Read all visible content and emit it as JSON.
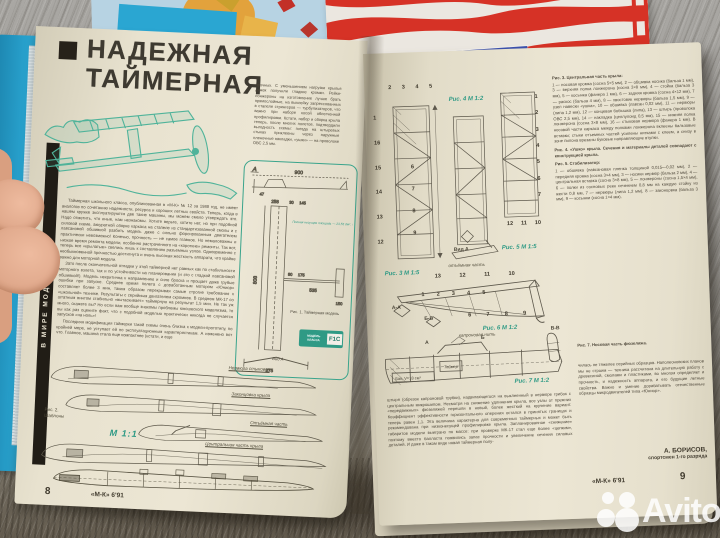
{
  "photo": {
    "watermark_brand": "Avito"
  },
  "colors": {
    "teal_ink": "#2f9a85",
    "paper": "#e8e2cf",
    "banner_blue": "#3d52ae",
    "stripe_red": "#d63226",
    "book_cyan": "#2aa6d2"
  },
  "background_magazines": {
    "banner_title": "ЛИЧНОЕ ОРУЖИЕ"
  },
  "left_page": {
    "rubric_strip": "В МИРЕ МОДЕЛЕЙ",
    "headline": {
      "line1": "НАДЕЖНАЯ",
      "line2": "ТАЙМЕРНАЯ"
    },
    "intro_column": "прочных. С уменьшением нагрузки крылья дужек получили гладкие кромки. Рейки-лонжероны на изготовление лучше брать прямослойные, на выклейку запрессованных в стапеле стрингеров — турбулизаторов, что важно при наборе косой облегченной профилировки. Кстати, набор и сборка крыла теперь, после многих полетов, подтвердили выгодность схемы: гнезда на штыревых стыках приклеены через наружные пленочные накладки, «ушки» — на проволоке ОВС 2,5 мм.",
    "body_p1": "Таймерная школьного класса, опубликованная в «М-К» № 12 за 1988 год, не имеет аналогов по сочетанию надежности, ресурса и хороших летных свойств. Теперь, когда в нашем кружке эксплуатируются две такие машины, мы можем смело утверждать это. Надо отметить, что иные, нам незнакомы. Хотите верьте, хотите нет, но при подобной силовой схеме, аккуратной сборке каркаса на стапеле из стандартизованной смолы и с лавсановой обшивкой разбить модель даже с сильно форсированным двигателем практически невозможно! Конечно, прочность — не самое главное. Но немаловажны и низкое время ремонта модели, особенно растраченного на «короткие» ремонты. Так вот, теперь все «крылатые» свелись лишь к составлению разъемных узлов. Одновременно с необыкновенной прочностью достигнута и очень высокая жесткость аппарата, что крайне важно для моторной модели.",
    "body_p2": "Зато после окончательной отладки у этой таймерной нет равных как по стабильности моторного взлета, так и по устойчивости на планировании (и это с гладкой лавсановой обшивкой!). Модель некритична к направлению и силе броска и прощает даже грубые ошибки при запуске. Среднее время полета с доработанным мотором «Юниор» составляет более 3 мин, таким образом перекрывая самые строгие требования к «школьной» технике. Результаты с серийным двигателем скромнее. В среднем МК-17 со штатным винтом стабильно «вытаскивает» таймерную на результат 1,5 мин. Не так уж много, скажете вы? Но если вам вообще знакомы проблемы юношеского моделизма, то вы как раз оцените факт, что с подобной моделью практически никогда не случается запусков «на ноль»!",
    "body_p3": "Последняя модификация таймерки такой схемы очень близка к модели-прототипу, по крайней мере, не уступает ей по эксплуатационным характеристикам. А изменено вот что. Главное, машина стала еще компактнее (кстати, и еще",
    "fig1": {
      "marker_a": "А",
      "annotation": "Полная несущая площадь — 23,55 дм². Профиль крыла — плосковыпуклый, установочный угол +2°. Нагрузка при полетной массе — 19 г/дм².",
      "caption": "Рис. 1. Таймерная модель",
      "view_label": "Вид А",
      "badge": {
        "line1": "МОДЕЛЬ",
        "line2": "КЛАССА",
        "class_code": "F1C"
      },
      "dims": {
        "d900": "900",
        "d47": "47",
        "d808": "808",
        "d258": "258",
        "d30": "30",
        "d145": "145",
        "d80": "80",
        "d175": "175",
        "d535": "535",
        "d150": "150",
        "d275": "275"
      }
    },
    "fig2": {
      "label_line1": "Рис. 2.",
      "label_line2": "Шаблоны",
      "scale": "М 1:1",
      "labels": [
        "Нервюра стыковая",
        "Законцовка крыла",
        "Отъёмная часть",
        "Центральная часть крыла"
      ]
    },
    "footer": {
      "page": "8",
      "issue": "«М-К» 6'91"
    }
  },
  "right_page": {
    "fig3": {
      "scale_label": "Рис. 3  М 1:5",
      "callouts_top": [
        "2",
        "3",
        "4",
        "5"
      ],
      "callouts_left": [
        "1",
        "16",
        "15",
        "14",
        "13",
        "12"
      ],
      "callouts_bottom": [
        "6",
        "7",
        "8",
        "9"
      ]
    },
    "fig4": {
      "scale_label": "Рис. 4  М 1:2",
      "view_label": "Вид А",
      "sub_label": "отъёмная часть"
    },
    "fig5": {
      "scale_label": "Рис. 5  М 1:5",
      "callouts": [
        "1",
        "2",
        "3",
        "4",
        "5",
        "6",
        "7"
      ],
      "callouts_bottom": [
        "12",
        "11",
        "10"
      ]
    },
    "fig6": {
      "scale_label": "Рис. 6  М 1:2",
      "callouts_top": [
        "13",
        "12",
        "11",
        "10"
      ],
      "callouts_mid": [
        "1",
        "2",
        "3",
        "4",
        "5"
      ],
      "callouts_bottom": [
        "6",
        "7",
        "8",
        "9"
      ],
      "section_aa": "А-А",
      "section_bb": "Б-Б"
    },
    "fig7": {
      "scale_label": "Рис. 7  М 1:2",
      "tank_label": "Бак, V=18 см³",
      "timer_label": "Таймер",
      "section_vv": "В-В",
      "arrow_note": "капроновая нить",
      "marker_a": "А",
      "marker_b": "Б"
    },
    "captions": {
      "fig3_title": "Рис. 3. Центральная часть крыла:",
      "fig3_body": "1 — носовая кромка (сосна 5×5 мм), 2 — обшивка носика (бальза 1 мм), 3 — верхняя полка лонжерона (сосна 3×8 мм), 4 — стойка (бальза 3 мм), 5 — косынка (фанера 1 мм), 6 — задняя кромка (сосна 4×12 мм), 7 — раскос (бальза 4 мм), 8 — хвостовик нервюры (бальза 1,5 мм), 9 — узел навески «ушка», 10 — обшивка (лавсан 0,02 мм), 11 — нервюры (липа 1,2 мм), 12 — концевая бобышка (липа), 13 — штырь (проволока ОВС 2,5 мм), 14 — накладка (целлулоид 0,5 мм), 15 — нижняя полка лонжерона (сосна 3×8 мм), 16 — стыковая нервюра (фанера 1 мм). В носовой части каркаса между полками лонжерона вклеены бальзовые вставки; стыки отъемных частей усилены нитками с клеем, а снизу в зоне пилона врезаны буковые направляющие втулки.",
      "fig4_note": "Рис. 4. «Ушко» крыла. Сечения и материалы деталей совпадают с конструкцией крыла.",
      "fig5_title": "Рис. 5. Стабилизатор:",
      "fig5_body": "1 — обшивка (лавсановая пленка толщиной 0,015—0,02 мм), 2 — передняя кромка (сосна 3×4 мм), 3 — носики нервюр (бальза 2 мм), 4 — центральная вставка (сосна 3×8 мм), 5 — лонжероны (сосна 1,5×4 мм), 6 — полки из сосновых реек сечением 0,8 мм на каждую стойку из жести 0,8 мм, 7 — нервюры (липа 1,2 мм), 8 — законцовка (бальза 3 мм), 9 — косынки (сосна 1×4 мм).",
      "fig7_note": "Рис. 7. Носовая часть фюзеляжа."
    },
    "bottom_paragraph": "штыря (обрезок капроновой трубки), надвигающегося на выклеенный в нервюре грибок с центральным микрошипом. Несмотря на снижение удлинения крыла, все узлы от прежних «передвижных» фюзеляжей перешли в новый, более жесткий на кручение вариант. Коэффициент эффективности горизонтального оперения остался в принятых границах и теперь равен 1,1. Эта величина характерна для современных таймерных и может быть рекомендована при низконесущей профилировке крыла. Запланированное «снижение» габаритов модели выиграно по массе: при проверке МК-17 стал еще более «цепким», поэтому вместо балласта появились запас прочности и увеличение сечения силовых деталей. И даже в таком виде новая таймерная полу-",
    "bottom_right_paragraph": "чилась не тяжелее серийных образцов. Наполеоновских планов мы не строим — техника рассчитана на длительную работу с древесиной, смолами и пластиками, во многом определяет и прочность, и надежность аппарата, и его будущие летные свойства. Важно и умение дорабатывать отечественные образцы микродвигателей типа «Юниор».",
    "author": {
      "name": "А. БОРИСОВ,",
      "title": "спортсмен 1-го разряда"
    },
    "footer": {
      "issue": "«М-К» 6'91",
      "page": "9"
    }
  }
}
